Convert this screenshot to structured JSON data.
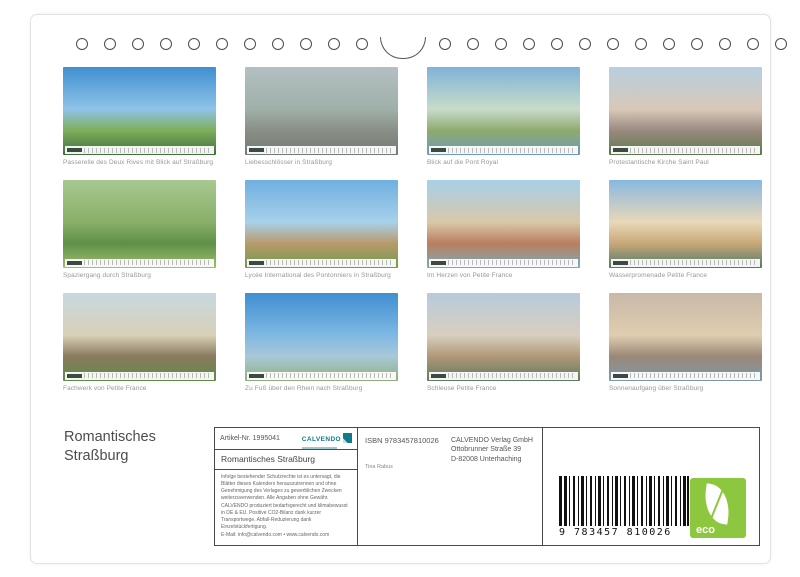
{
  "cover": {
    "title": "Romantisches\nStraßburg"
  },
  "thumbnails": [
    {
      "caption": "Passerelle des Deux Rives mit Blick auf Straßburg",
      "colors": [
        "#3f8fd0",
        "#8fc3e8",
        "#7fae5a",
        "#3f6f3f"
      ]
    },
    {
      "caption": "Liebesschlösser in Straßburg",
      "colors": [
        "#b4bfc2",
        "#9fb0a8",
        "#8a8f86",
        "#6f7a74"
      ]
    },
    {
      "caption": "Blick auf die Pont Royal",
      "colors": [
        "#7fb2d8",
        "#c8dcc8",
        "#8faa70",
        "#6f9ab8"
      ]
    },
    {
      "caption": "Protestantische Kirche Saint Paul",
      "colors": [
        "#b8cfe0",
        "#d8c8b8",
        "#9a8a80",
        "#5a7a4a"
      ]
    },
    {
      "caption": "Spaziergang durch Straßburg",
      "colors": [
        "#a8c890",
        "#88b068",
        "#5f8f48",
        "#9fbf6f"
      ]
    },
    {
      "caption": "Lycée International des Pontonniers in Straßburg",
      "colors": [
        "#6fb0e0",
        "#a8d0ea",
        "#b89a6a",
        "#6f9a50"
      ]
    },
    {
      "caption": "Im Herzen von Petite France",
      "colors": [
        "#a8d0e8",
        "#d8c8a8",
        "#b87f5f",
        "#7fa8b8"
      ]
    },
    {
      "caption": "Wasserpromenade Petite France",
      "colors": [
        "#88b8e0",
        "#e8d8b8",
        "#c8a878",
        "#4f7a6a"
      ]
    },
    {
      "caption": "Fachwerk von Petite France",
      "colors": [
        "#c8d8e0",
        "#d8d0b8",
        "#8a7a5f",
        "#5f8a48"
      ]
    },
    {
      "caption": "Zu Fuß über den Rhein nach Straßburg",
      "colors": [
        "#3f8fd2",
        "#7fb8e2",
        "#a8c8d8",
        "#8faf7f"
      ]
    },
    {
      "caption": "Schleuse Petite France",
      "colors": [
        "#b8cadb",
        "#d8cfc0",
        "#b09878",
        "#5f7a62"
      ]
    },
    {
      "caption": "Sonnenaufgang über Straßburg",
      "colors": [
        "#c8b8a8",
        "#e0cdb0",
        "#9a8878",
        "#7f98a8"
      ]
    }
  ],
  "info": {
    "artikel": "Artikel-Nr. 1995041",
    "brand": "CALVENDO",
    "product_title": "Romantisches Straßburg",
    "legal_lines": [
      "Infolge bestehender Schutzrechte ist es untersagt, die Blätter dieses Kalenders herauszutrennen und ohne Genehmigung des Verlages zu gewerblichen Zwecken weiterzuverwenden. Alle Angaben ohne Gewähr.",
      "CALVENDO produziert bedarfsgerecht und klimabewusst in DE & EU. Positive CO2-Bilanz dank kurzer Transportwege. Abfall-Reduzierung dank Einzelstückfertigung.",
      "E-Mail: info@calvendo.com • www.calvendo.com"
    ],
    "isbn": "ISBN 9783457810026",
    "publisher_lines": [
      "CALVENDO Verlag GmbH",
      "Ottobrunner Straße 39",
      "D-82008 Unterhaching"
    ],
    "author": "Tina Rabus",
    "barcode_digits": "9 783457 810026",
    "eco_label": "eco",
    "brand_color": "#117a8a",
    "eco_color": "#8dc63f"
  },
  "binding": {
    "hole_count": 26
  }
}
